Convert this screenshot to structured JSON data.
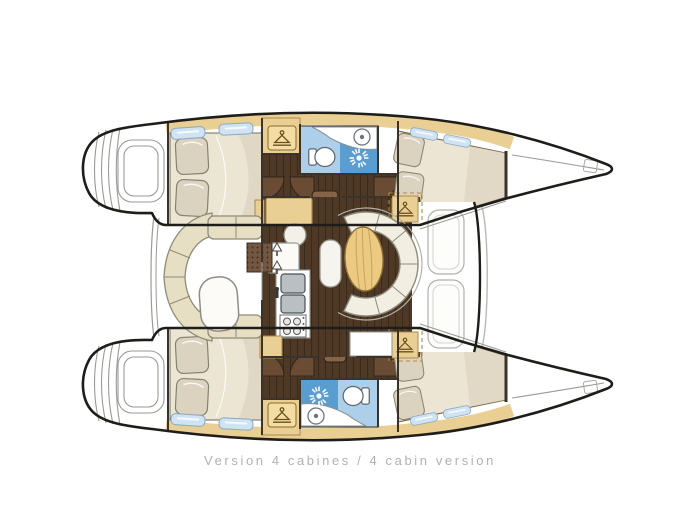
{
  "caption": {
    "text": "Version 4 cabines / 4 cabin version"
  },
  "colors": {
    "background": "#ffffff",
    "outline": "#1f1d1a",
    "wall": "#3a332c",
    "line_gray": "#9b9a95",
    "wood_trim": "#e9cf93",
    "wood_trim_dark": "#a88a4e",
    "floor_dark": "#4e3927",
    "door_brown": "#6a4c35",
    "cushion": "#e7dfc4",
    "cushion_line": "#8d8b78",
    "mattress": "#ece5d3",
    "mattress_shade": "#d8cebb",
    "pillow": "#dbd3c0",
    "sofa": "#f2eee1",
    "table_wood": "#ecca82",
    "table_grain": "#c9a45f",
    "bath_blue_light": "#adcfe9",
    "bath_blue_mid": "#5a9dd1",
    "hatch_glass": "#cfe3f2",
    "steel": "#b9bfc3",
    "steel_dark": "#4a5054",
    "white_fixture": "#fbfaf7",
    "caption_gray": "#b2b1ae"
  },
  "icons": [
    {
      "name": "hanger-icon",
      "meaning": "wardrobe / hanging locker"
    },
    {
      "name": "shower-sun-icon",
      "meaning": "shower"
    },
    {
      "name": "toilet-icon",
      "meaning": "marine toilet"
    },
    {
      "name": "sink-icon",
      "meaning": "washbasin"
    },
    {
      "name": "stove-icon",
      "meaning": "galley cooktop"
    },
    {
      "name": "steps-icon",
      "meaning": "companionway steps"
    },
    {
      "name": "arrow-up-icon",
      "meaning": "access arrows"
    }
  ]
}
